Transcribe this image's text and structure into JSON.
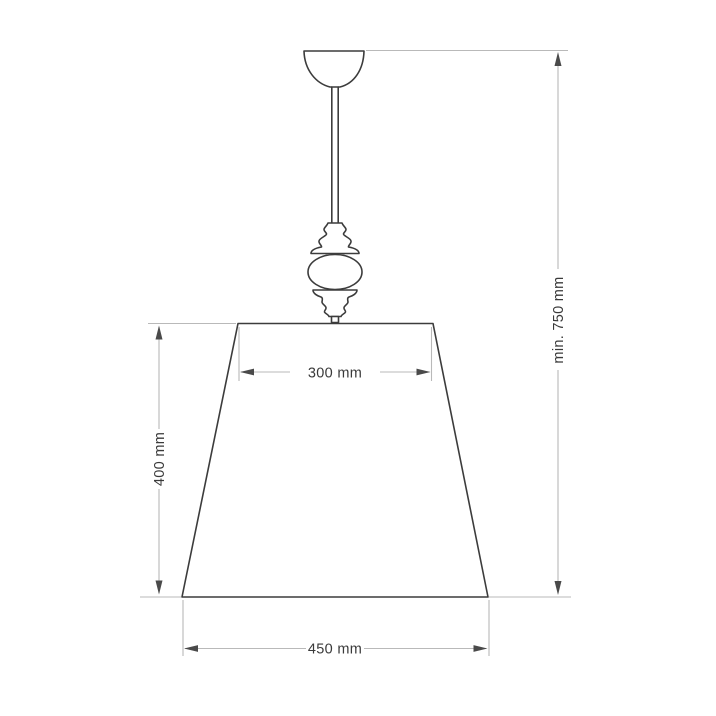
{
  "figure": {
    "kind": "pendant-lamp-dimension-drawing",
    "labels": {
      "shade_top_width": "300 mm",
      "shade_height": "400 mm",
      "shade_bottom_width": "450 mm",
      "overall_height": "min. 750 mm"
    },
    "colors": {
      "background": "#ffffff",
      "outline": "#3c3c3c",
      "dimension_line": "#b9b9b9",
      "arrow": "#4a4a4a",
      "label_text": "#3a3a3a"
    }
  }
}
